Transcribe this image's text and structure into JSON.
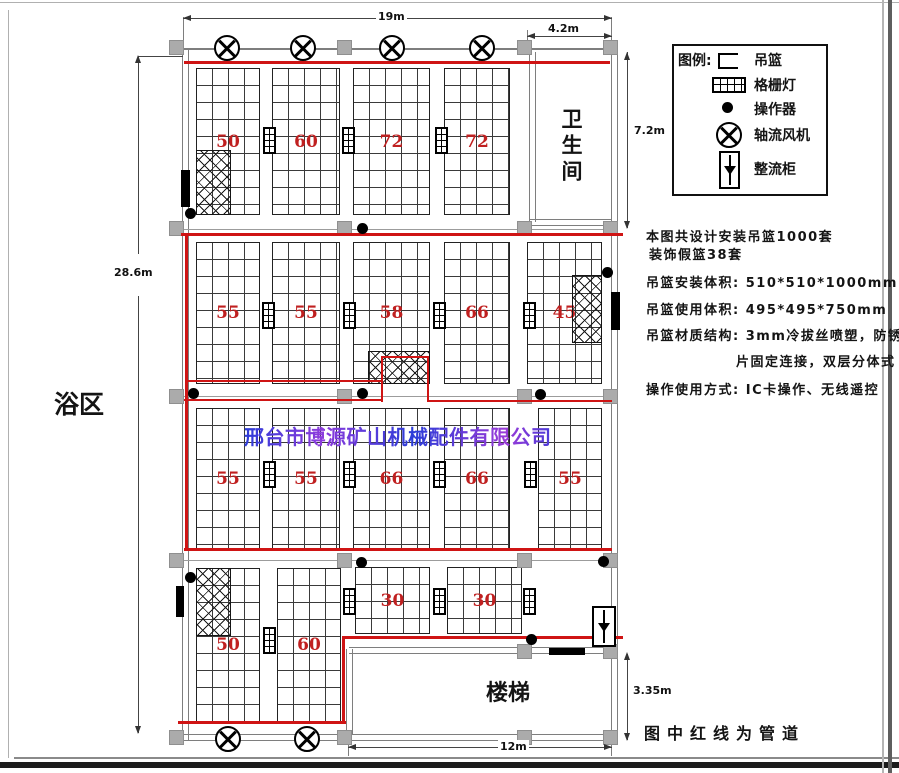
{
  "watermark": {
    "text": "邢台市博源矿山机械配件有限公司"
  },
  "legend": {
    "title": "图例:",
    "items": [
      {
        "icon": "basket-icon",
        "label": "吊篮"
      },
      {
        "icon": "grille-light-icon",
        "label": "格栅灯"
      },
      {
        "icon": "operator-box-icon",
        "label": "操作器"
      },
      {
        "icon": "axial-fan-icon",
        "label": "轴流风机"
      },
      {
        "icon": "rectifier-cabinet-icon",
        "label": "整流柜"
      }
    ]
  },
  "notes": {
    "line1": "本图共设计安装吊篮1000套",
    "line2": "装饰假篮38套",
    "install_label": "吊篮安装体积:",
    "install_value": "510*510*1000mm",
    "use_label": "吊篮使用体积:",
    "use_value": "495*495*750mm",
    "material_label": "吊篮材质结构:",
    "material_value_1": "3mm冷拔丝喷塑，防锈铆",
    "material_value_2": "片固定连接，双层分体式",
    "operate_label": "操作使用方式:",
    "operate_value": "IC卡操作、无线遥控"
  },
  "rooms": {
    "bath": "浴区",
    "toilet": "卫生间",
    "stairs": "楼梯"
  },
  "dims": {
    "top": "19m",
    "top_right": "4.2m",
    "toilet_height": "7.2m",
    "left": "28.6m",
    "stairs_height": "3.35m",
    "bottom": "12m"
  },
  "pipe_note": "图中红线为管道",
  "racks": {
    "row1": [
      "50",
      "60",
      "72",
      "72"
    ],
    "row2": [
      "55",
      "55",
      "58",
      "66",
      "45"
    ],
    "row3": [
      "55",
      "55",
      "66",
      "66",
      "55"
    ],
    "row4": [
      "50",
      "60"
    ],
    "row4b": [
      "30",
      "30"
    ]
  },
  "colors": {
    "pipe_red": "#cf1414",
    "count_red": "#c02020",
    "column_gray": "#ababab",
    "watermark_blue": "#2b3cd8",
    "watermark_purple": "#8d3bdc"
  }
}
